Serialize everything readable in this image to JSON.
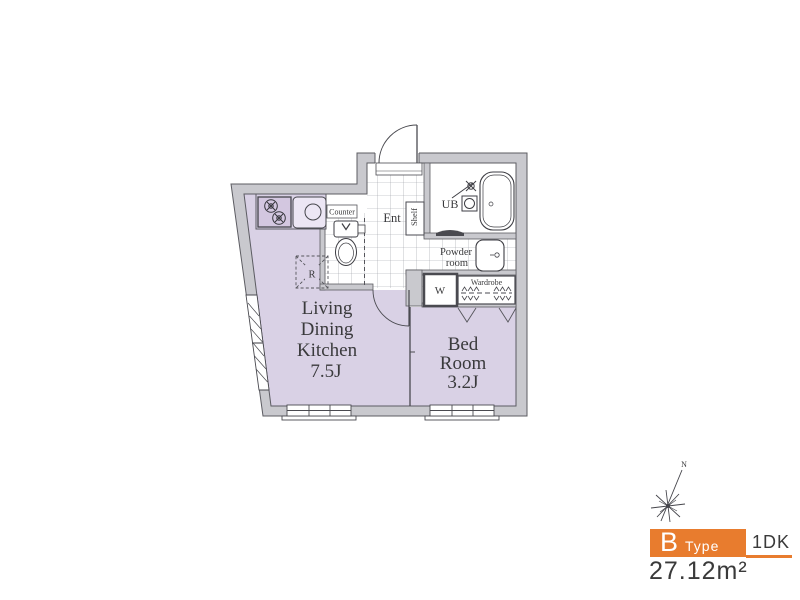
{
  "plan": {
    "rooms": {
      "ldk": [
        "Living",
        "Dining",
        "Kitchen",
        "7.5J"
      ],
      "bedroom": [
        "Bed",
        "Room",
        "3.2J"
      ]
    },
    "labels": {
      "entrance": "Ent",
      "unit_bath": "UB",
      "powder_line1": "Powder",
      "powder_line2": "room",
      "shelf": "Shelf",
      "counter": "Counter",
      "washer_closet": "W",
      "wardrobe": "Wardrobe",
      "refrigerator": "R",
      "north": "N"
    }
  },
  "legend": {
    "type_letter": "B",
    "type_word": "Type",
    "layout": "1DK",
    "area": "27.12m²"
  },
  "colors": {
    "accent_orange": "#e87c2e",
    "room_fill": "#d9d1e5",
    "wall_fill": "#c9c9ce",
    "ink": "#3a3a3c"
  }
}
